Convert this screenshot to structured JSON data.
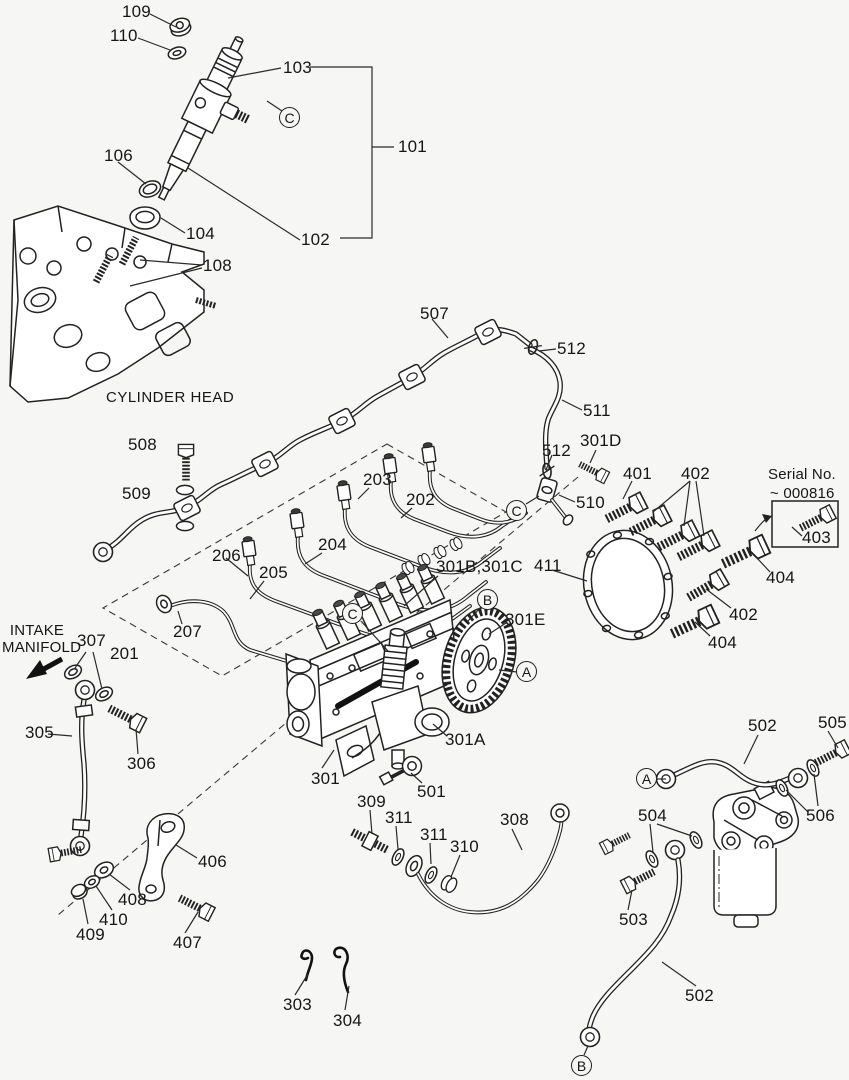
{
  "page": {
    "background": "#f6f6f5",
    "ink": "#222222"
  },
  "diagram": {
    "annotations": {
      "cylinder_head": "CYLINDER HEAD",
      "intake_manifold_l1": "INTAKE",
      "intake_manifold_l2": "MANIFOLD",
      "serial_l1": "Serial No.",
      "serial_l2": "~ 000816"
    },
    "part_labels": {
      "p101": "101",
      "p102": "102",
      "p103": "103",
      "p104": "104",
      "p106": "106",
      "p108": "108",
      "p109": "109",
      "p110": "110",
      "p201": "201",
      "p202": "202",
      "p203": "203",
      "p204": "204",
      "p205": "205",
      "p206": "206",
      "p207": "207",
      "p301": "301",
      "p301A": "301A",
      "p301BC": "301B,301C",
      "p301D": "301D",
      "p301E": "301E",
      "p303": "303",
      "p304": "304",
      "p305": "305",
      "p306": "306",
      "p307": "307",
      "p308": "308",
      "p309": "309",
      "p310": "310",
      "p311a": "311",
      "p311b": "311",
      "p401": "401",
      "p402a": "402",
      "p402b": "402",
      "p403": "403",
      "p404a": "404",
      "p404b": "404",
      "p406": "406",
      "p407": "407",
      "p408": "408",
      "p409": "409",
      "p410": "410",
      "p411": "411",
      "p501": "501",
      "p502a": "502",
      "p502b": "502",
      "p503": "503",
      "p504": "504",
      "p505": "505",
      "p506": "506",
      "p507": "507",
      "p508": "508",
      "p509": "509",
      "p510": "510",
      "p511": "511",
      "p512a": "512",
      "p512b": "512"
    },
    "view_markers": {
      "a1": "A",
      "a2": "A",
      "b1": "B",
      "b2": "B",
      "c1": "C",
      "c2": "C",
      "c3": "C"
    }
  }
}
